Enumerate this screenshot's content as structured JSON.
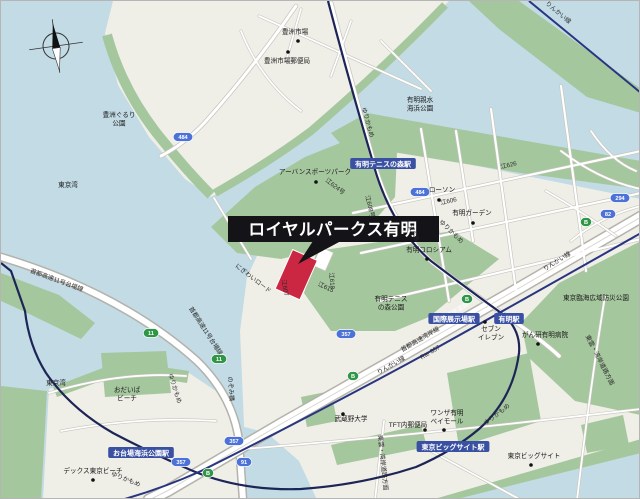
{
  "map": {
    "title_callout": {
      "label": "ロイヤルパークス有明"
    },
    "colors": {
      "water": "#c2dbe5",
      "land": "#efeee7",
      "park": "#a5c79d",
      "road": "#ffffff",
      "road_casing": "#c6c5be",
      "highway_casing": "#b3b2ab",
      "rail": "#1d2557",
      "rinkai_rail": "#2a3580",
      "station_bg": "#3a51a3",
      "badge_blue": "#4c72d8",
      "badge_green": "#2f9647",
      "marker_red": "#cb2742",
      "callout_bg": "#141418"
    },
    "poi_labels": [
      {
        "lines": [
          "豊洲市場"
        ],
        "x": 294,
        "y": 33,
        "dot": [
          297,
          40
        ]
      },
      {
        "lines": [
          "豊洲市場郵便局"
        ],
        "x": 286,
        "y": 62,
        "dot": [
          287,
          51
        ]
      },
      {
        "lines": [
          "豊洲ぐるり",
          "公園"
        ],
        "x": 118,
        "y": 116
      },
      {
        "lines": [
          "東京湾"
        ],
        "x": 67,
        "y": 186
      },
      {
        "lines": [
          "東京湾"
        ],
        "x": 55,
        "y": 384
      },
      {
        "lines": [
          "アーバンスポーツパーク"
        ],
        "x": 314,
        "y": 173,
        "dot": [
          315,
          181
        ]
      },
      {
        "lines": [
          "有明親水",
          "海浜公園"
        ],
        "x": 419,
        "y": 101
      },
      {
        "lines": [
          "ローソン"
        ],
        "x": 441,
        "y": 191,
        "dot": [
          438,
          199
        ]
      },
      {
        "lines": [
          "有明ガーデン"
        ],
        "x": 471,
        "y": 214,
        "dot": [
          472,
          222
        ]
      },
      {
        "lines": [
          "有明コロシアム"
        ],
        "x": 428,
        "y": 251,
        "dot": [
          426,
          258
        ]
      },
      {
        "lines": [
          "有明テニス",
          "の森公園"
        ],
        "x": 390,
        "y": 300
      },
      {
        "lines": [
          "セブン",
          "イレブン"
        ],
        "x": 490,
        "y": 330,
        "dot": [
          484,
          321
        ]
      },
      {
        "lines": [
          "がん研有明病院"
        ],
        "x": 544,
        "y": 336,
        "dot": [
          537,
          343
        ]
      },
      {
        "lines": [
          "東京臨海広域防災公園"
        ],
        "x": 595,
        "y": 299
      },
      {
        "lines": [
          "武蔵野大学"
        ],
        "x": 350,
        "y": 420,
        "dot": [
          342,
          413
        ]
      },
      {
        "lines": [
          "TFT内郵便局"
        ],
        "x": 407,
        "y": 426,
        "dot": [
          424,
          429
        ]
      },
      {
        "lines": [
          "ワンザ有明",
          "ベイモール"
        ],
        "x": 446,
        "y": 414,
        "dot": [
          443,
          429
        ]
      },
      {
        "lines": [
          "東京ビッグサイト"
        ],
        "x": 533,
        "y": 457,
        "dot": [
          530,
          464
        ]
      },
      {
        "lines": [
          "おだいば",
          "ビーチ"
        ],
        "x": 126,
        "y": 391
      },
      {
        "lines": [
          "デックス東京ビーチ"
        ],
        "x": 92,
        "y": 472,
        "dot": [
          92,
          479
        ]
      }
    ],
    "station_labels": [
      {
        "text": "有明テニスの森駅",
        "x": 382,
        "y": 163
      },
      {
        "text": "国際展示場駅",
        "x": 453,
        "y": 318
      },
      {
        "text": "有明駅",
        "x": 508,
        "y": 318
      },
      {
        "text": "東京ビッグサイト駅",
        "x": 452,
        "y": 446
      },
      {
        "text": "お台場海浜公園駅",
        "x": 140,
        "y": 452
      }
    ],
    "road_labels": [
      {
        "text": "ゆりかもめ",
        "x": 365,
        "y": 122,
        "rot": 74
      },
      {
        "text": "ゆりかもめ",
        "x": 449,
        "y": 232,
        "rot": 44
      },
      {
        "text": "ゆりかもめ",
        "x": 172,
        "y": 388,
        "rot": 72
      },
      {
        "text": "ゆりかもめ",
        "x": 124,
        "y": 480,
        "rot": 22
      },
      {
        "text": "ゆりかもめ",
        "x": 497,
        "y": 415,
        "rot": -38
      },
      {
        "text": "首都高速11号台場線",
        "x": 55,
        "y": 281,
        "rot": 20
      },
      {
        "text": "首都高速11号台場線",
        "x": 203,
        "y": 331,
        "rot": 57
      },
      {
        "text": "東京湾岸道路",
        "x": 452,
        "y": 314,
        "rot": -30.5,
        "color": "#ffffff"
      },
      {
        "text": "首都高速湾岸線",
        "x": 420,
        "y": 340,
        "rot": -30.5
      },
      {
        "text": "Rte 357",
        "x": 430,
        "y": 353,
        "rot": -30.5
      },
      {
        "text": "りんかい線",
        "x": 556,
        "y": 13,
        "rot": 40
      },
      {
        "text": "りんかい線",
        "x": 557,
        "y": 262,
        "rot": -32
      },
      {
        "text": "りんかい線",
        "x": 391,
        "y": 366,
        "rot": -30
      },
      {
        "text": "のぞみ橋",
        "x": 228,
        "y": 388,
        "rot": 85
      },
      {
        "text": "にぎわいロード",
        "x": 251,
        "y": 279,
        "rot": 38
      },
      {
        "text": "江607",
        "x": 282,
        "y": 287,
        "rot": 80
      },
      {
        "text": "江615",
        "x": 324,
        "y": 288,
        "rot": 25
      },
      {
        "text": "江624号",
        "x": 333,
        "y": 187,
        "rot": 38
      },
      {
        "text": "江608号",
        "x": 367,
        "y": 206,
        "rot": 76
      },
      {
        "text": "江625",
        "x": 411,
        "y": 233,
        "rot": 65
      },
      {
        "text": "江626",
        "x": 508,
        "y": 166,
        "rot": -13
      },
      {
        "text": "江606",
        "x": 448,
        "y": 202,
        "rot": -13
      },
      {
        "text": "江618",
        "x": 329,
        "y": 280,
        "rot": 85
      },
      {
        "text": "東雲・湾岸道路方面",
        "x": 597,
        "y": 360,
        "rot": 63
      },
      {
        "text": "東雲・湾岸道路方面",
        "x": 380,
        "y": 462,
        "rot": 84
      }
    ],
    "badges": [
      {
        "text": "484",
        "x": 182,
        "y": 136,
        "type": "blue"
      },
      {
        "text": "484",
        "x": 419,
        "y": 191,
        "type": "blue"
      },
      {
        "text": "357",
        "x": 345,
        "y": 333,
        "type": "blue"
      },
      {
        "text": "357",
        "x": 233,
        "y": 440,
        "type": "blue"
      },
      {
        "text": "357",
        "x": 180,
        "y": 461,
        "type": "blue"
      },
      {
        "text": "294",
        "x": 619,
        "y": 197,
        "type": "blue"
      },
      {
        "text": "82",
        "x": 607,
        "y": 213,
        "type": "blue"
      },
      {
        "text": "91",
        "x": 243,
        "y": 461,
        "type": "blue"
      },
      {
        "text": "11",
        "x": 218,
        "y": 358,
        "type": "green"
      },
      {
        "text": "11",
        "x": 150,
        "y": 332,
        "type": "green"
      },
      {
        "text": "B",
        "x": 466,
        "y": 298,
        "type": "green"
      },
      {
        "text": "B",
        "x": 352,
        "y": 375,
        "type": "green"
      },
      {
        "text": "B",
        "x": 585,
        "y": 221,
        "type": "green"
      },
      {
        "text": "B",
        "x": 207,
        "y": 472,
        "type": "green"
      }
    ]
  }
}
